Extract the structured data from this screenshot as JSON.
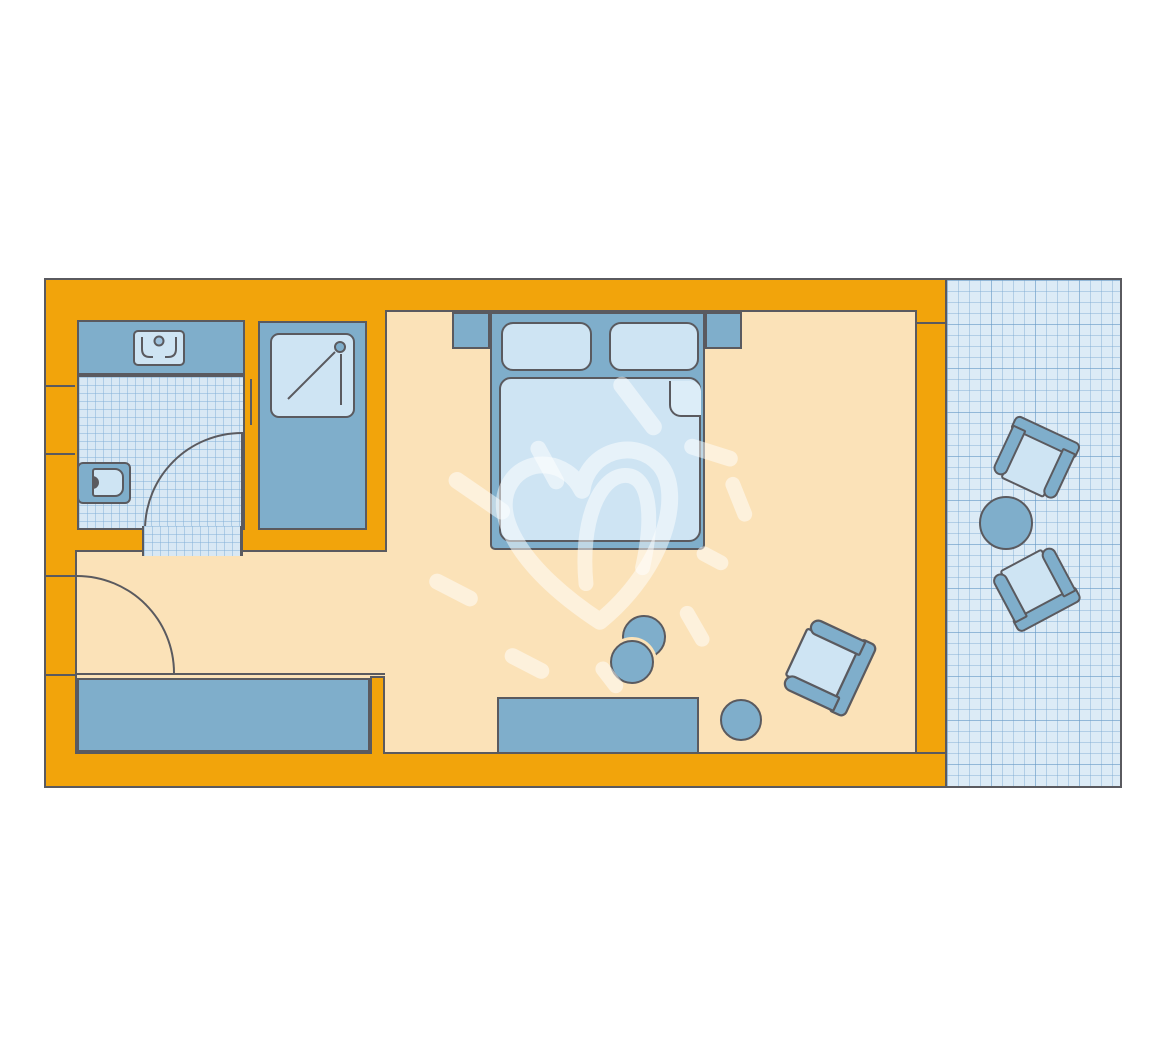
{
  "colors": {
    "wall": "#F2A40B",
    "floor": "#FBE2B8",
    "furn": "#7FAECB",
    "cushion": "#CEE4F3",
    "cushionBright": "#DCEDF8",
    "tile": "#D8E8F4",
    "balcony": "#DCEBF6",
    "line": "#5A5A5F",
    "pageBg": "#FFFFFF"
  },
  "floorplan": {
    "title": "hotel room floor plan",
    "rooms": [
      {
        "name": "bathroom",
        "floor": "tiled",
        "features": [
          "washbasin-vanity",
          "toilet",
          "shower-cabin",
          "inward-swinging-door"
        ]
      },
      {
        "name": "bedroom-living-room",
        "floor": "plain",
        "features": [
          "double-bed",
          "nightstand-left",
          "nightstand-right",
          "two-pillows",
          "duvet-with-folded-corner",
          "wardrobe",
          "sideboard",
          "paired-stools",
          "single-stool",
          "armchair",
          "entrance-door"
        ]
      },
      {
        "name": "balcony",
        "floor": "tiled-grid",
        "features": [
          "outdoor-chair",
          "outdoor-chair",
          "round-table"
        ]
      }
    ],
    "watermark": "hand-drawn-heart-with-rays"
  }
}
